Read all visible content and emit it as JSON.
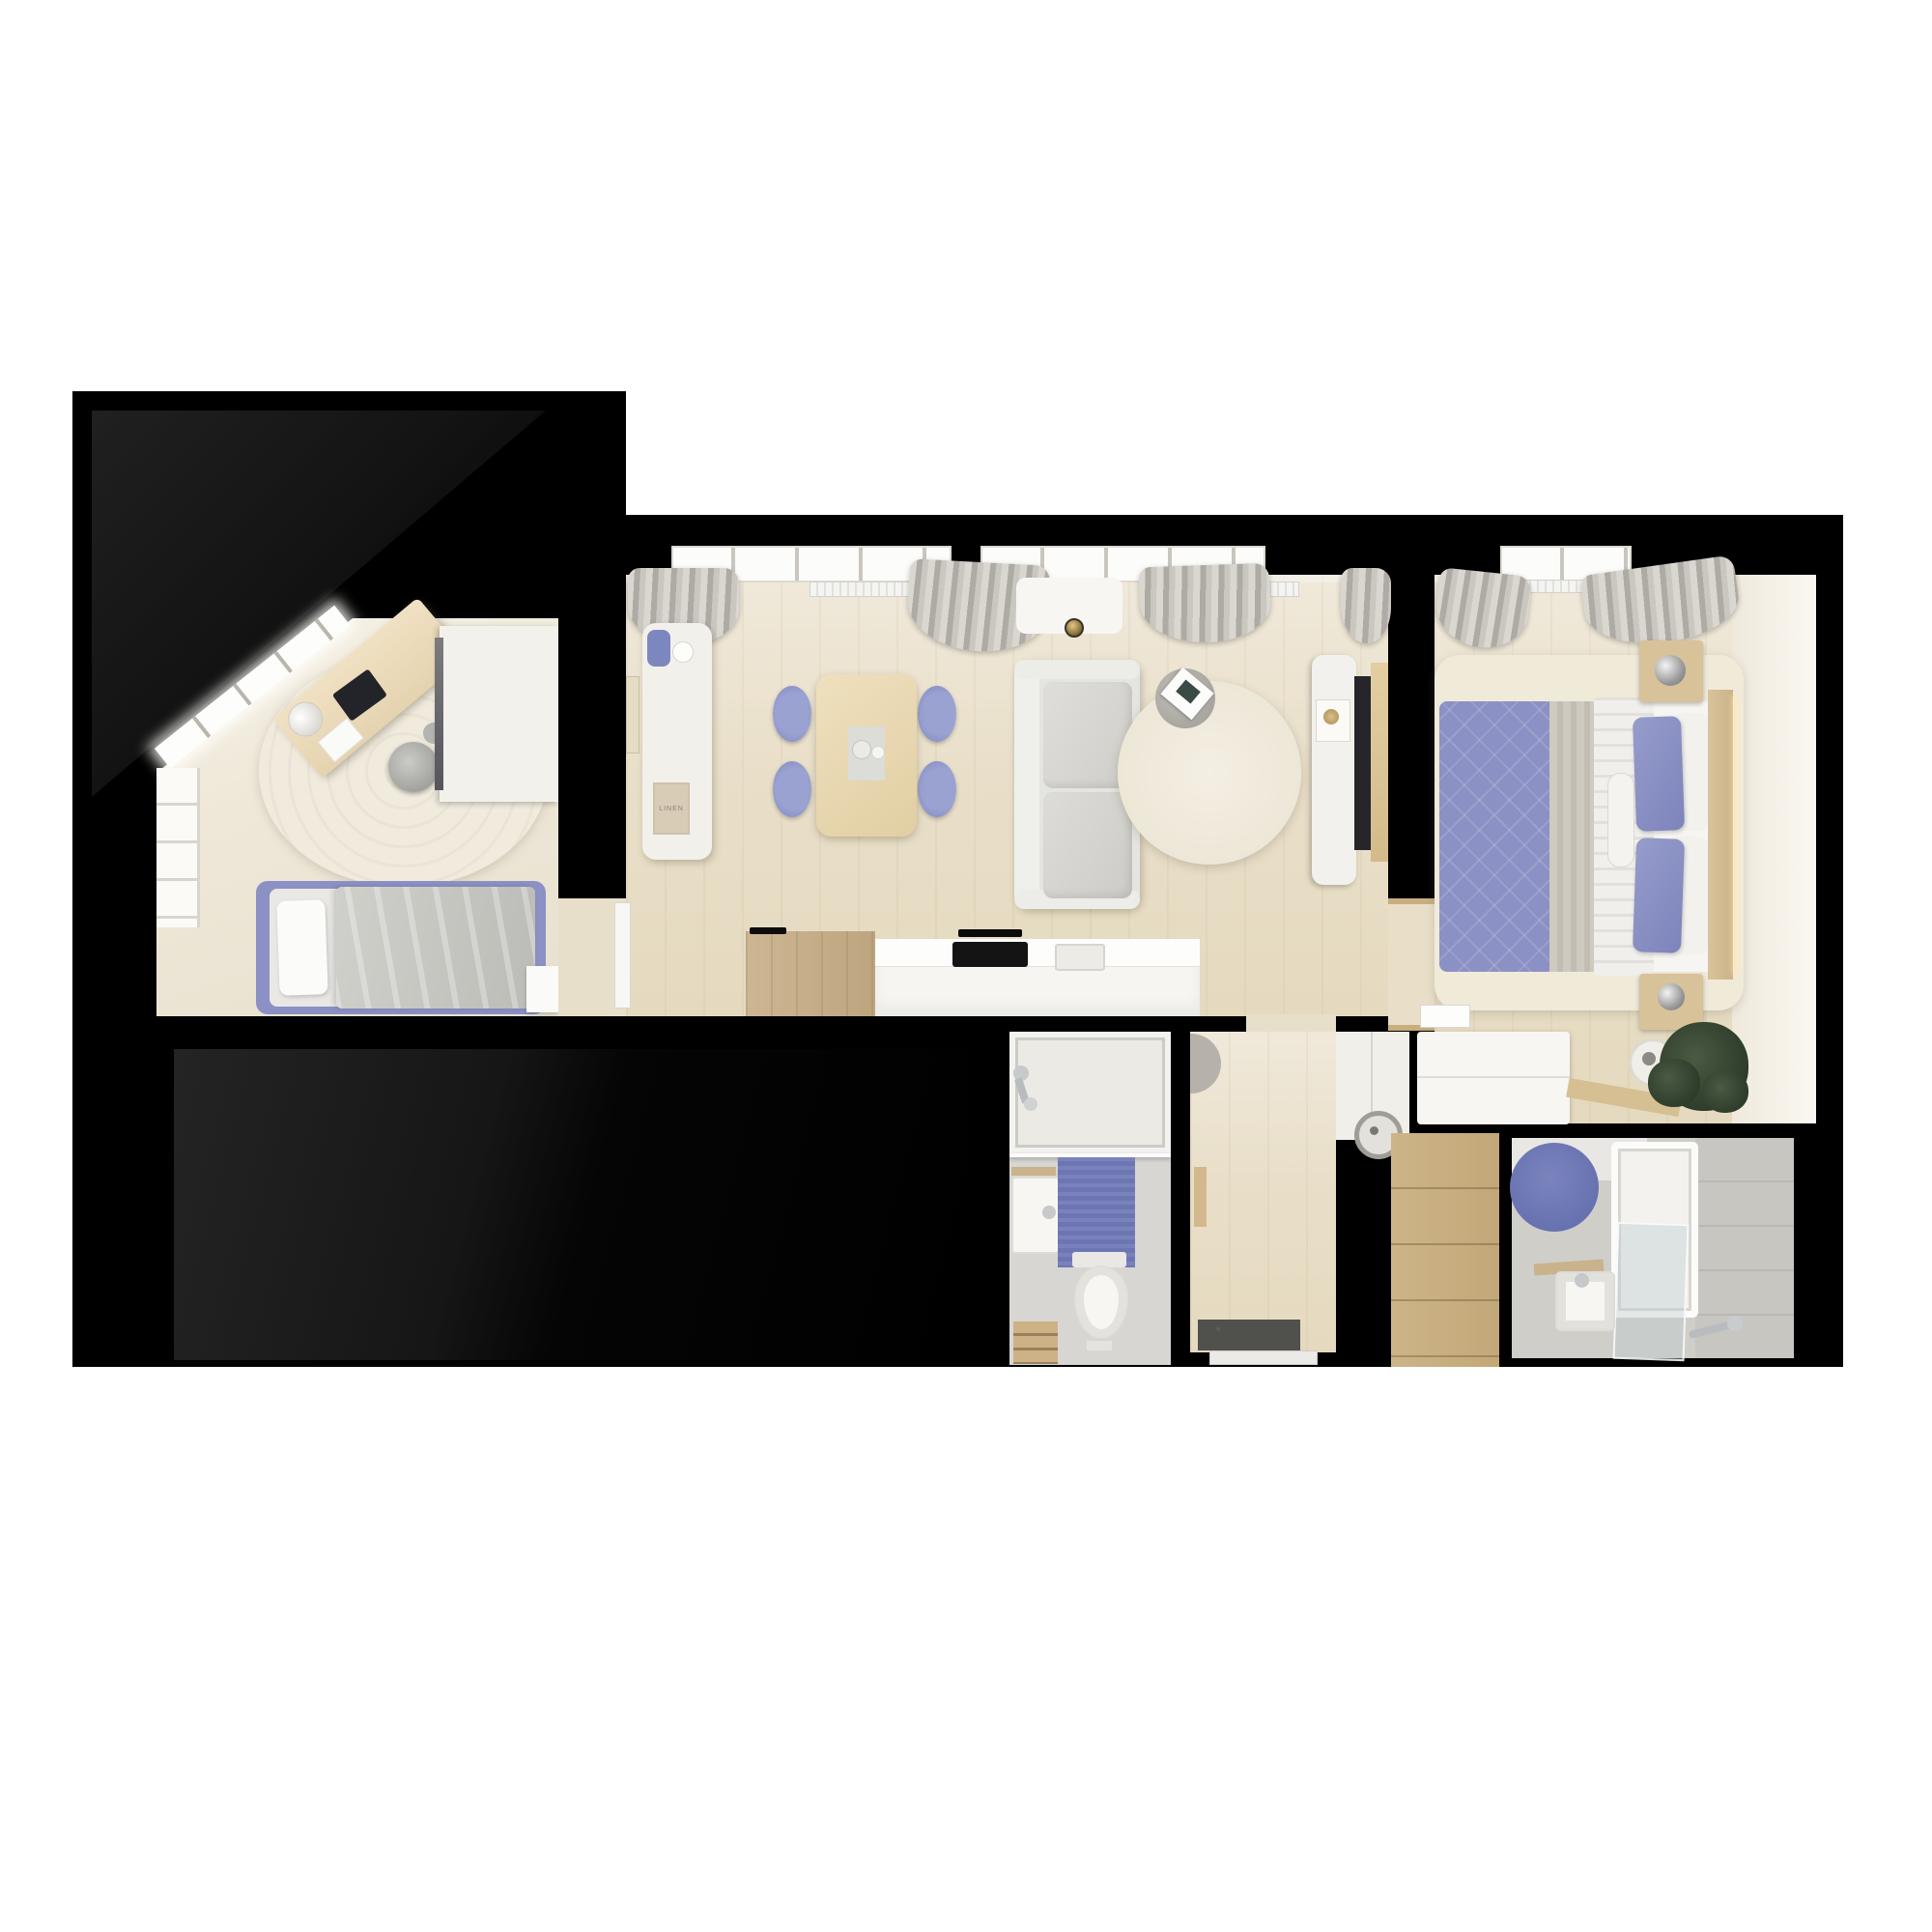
{
  "title": "apartment-floor-plan-top-view-render",
  "poster": {
    "label": "LINEN"
  },
  "colors": {
    "background": "#ffffff",
    "wall": "#000000",
    "floor_wood": "#e9dfc9",
    "floor_tile": "#d7d6d2",
    "rug_cream": "#f0ebdd",
    "accent_lavender": "#8b91c4",
    "curtain_grey": "#c7c4be",
    "counter_white": "#f6f5f2",
    "wood_furniture": "#cdb488",
    "cooktop_black": "#141414",
    "plant_green": "#35432f",
    "mat_blue": "#6d76b4"
  },
  "rooms": [
    {
      "id": "kids-room",
      "furniture": [
        "angled-window-wall",
        "side-window",
        "desk",
        "desk-lamp",
        "laptop",
        "office-chair",
        "round-rug",
        "single-bed-lavender-frame",
        "wardrobe",
        "mirror",
        "side-table"
      ]
    },
    {
      "id": "living-dining-kitchen",
      "furniture": [
        "windows-with-curtains",
        "radiators",
        "entry-cabinet",
        "blue-vase",
        "poster",
        "dining-table",
        "four-lavender-chairs",
        "centerpiece",
        "sofa",
        "round-rug",
        "side-table-with-magazine",
        "ceiling-lamp",
        "tv-console",
        "thermostat",
        "tv",
        "kitchen-counter-wood",
        "kitchen-counter-white",
        "cooktop",
        "sink"
      ]
    },
    {
      "id": "hallway",
      "furniture": [
        "pouf",
        "door-leaf",
        "entrance-doormat",
        "front-door"
      ]
    },
    {
      "id": "closet",
      "furniture": [
        "wardrobe",
        "washing-machine"
      ]
    },
    {
      "id": "bedroom",
      "furniture": [
        "window-with-curtains",
        "radiator",
        "double-bed",
        "blue-quilt",
        "duvet",
        "pillows",
        "bolster",
        "headboard-led",
        "nightstands",
        "sphere-lamps",
        "rug",
        "desk",
        "tray",
        "wood-board",
        "plant",
        "pot-clock"
      ]
    },
    {
      "id": "bathroom-small",
      "furniture": [
        "bathtub",
        "wall-faucet",
        "glass-screen",
        "wall-hung-sink",
        "blue-bath-mat",
        "toilet",
        "wood-step-stool"
      ]
    },
    {
      "id": "bathroom-main",
      "furniture": [
        "blue-round-rug",
        "bathtub",
        "glass-shower-screen",
        "square-sink",
        "wood-shelf",
        "hand-shower"
      ]
    }
  ]
}
